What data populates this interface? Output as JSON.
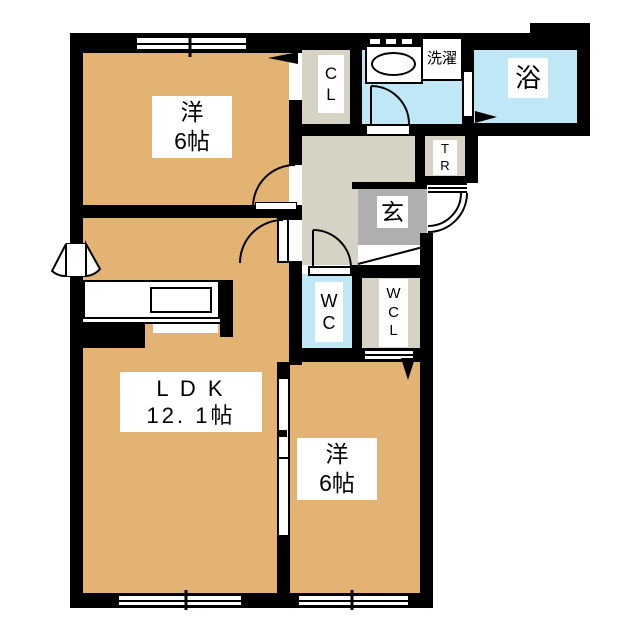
{
  "floorplan": {
    "title": "2LDK apartment floor plan",
    "colors": {
      "room_tan": "#E2B373",
      "wet_area_blue": "#BFE7F6",
      "hall_beige": "#D6D2C4",
      "genkan_gray": "#AFAFAF",
      "wall_black": "#000000",
      "label_bg": "#FFFFFF"
    },
    "labels": {
      "bedroom1": "洋\n6帖",
      "ldk": "L D K\n12. 1帖",
      "bedroom2": "洋\n6帖",
      "closet": "C\nL",
      "laundry": "洗濯",
      "bath": "浴",
      "trunk_room": "T\nR",
      "entrance": "玄",
      "toilet": "W\nC",
      "walk_in_closet": "W\nC\nL"
    }
  }
}
